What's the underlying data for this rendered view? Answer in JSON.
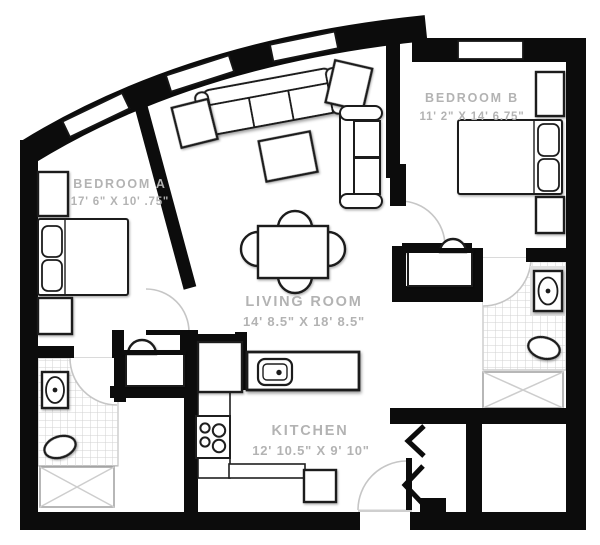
{
  "rooms": {
    "bedroom_a": {
      "name": "BEDROOM A",
      "dims": "17' 6\" X 10' .75\""
    },
    "bedroom_b": {
      "name": "BEDROOM B",
      "dims": "11' 2\" X 14' 6.75\""
    },
    "living_room": {
      "name": "LIVING ROOM",
      "dims": "14' 8.5\" X 18' 8.5\""
    },
    "kitchen": {
      "name": "KITCHEN",
      "dims": "12' 10.5\" X 9' 10\""
    }
  },
  "colors": {
    "wall": "#0c0c0c",
    "label": "#b3b3b3",
    "tile_line": "#d2d2d2",
    "door_arc": "#c6c6c6",
    "fixture_outline": "#1f1f1f",
    "background": "#ffffff"
  },
  "fixtures": [
    "sofa",
    "loveseat",
    "armchair-left",
    "armchair-right",
    "coffee-table",
    "dining-table",
    "dining-chairs",
    "bed-a",
    "nightstands-a",
    "bed-b",
    "nightstands-b",
    "kitchen-island-sink",
    "stove",
    "refrigerator",
    "dishwasher",
    "counters",
    "bath1-sink",
    "bath1-toilet",
    "bath1-shower",
    "vanity1-sink",
    "bath2-sink",
    "bath2-toilet",
    "bath2-shower",
    "vanity2-sink",
    "entry-door",
    "closet-doors",
    "windows"
  ]
}
